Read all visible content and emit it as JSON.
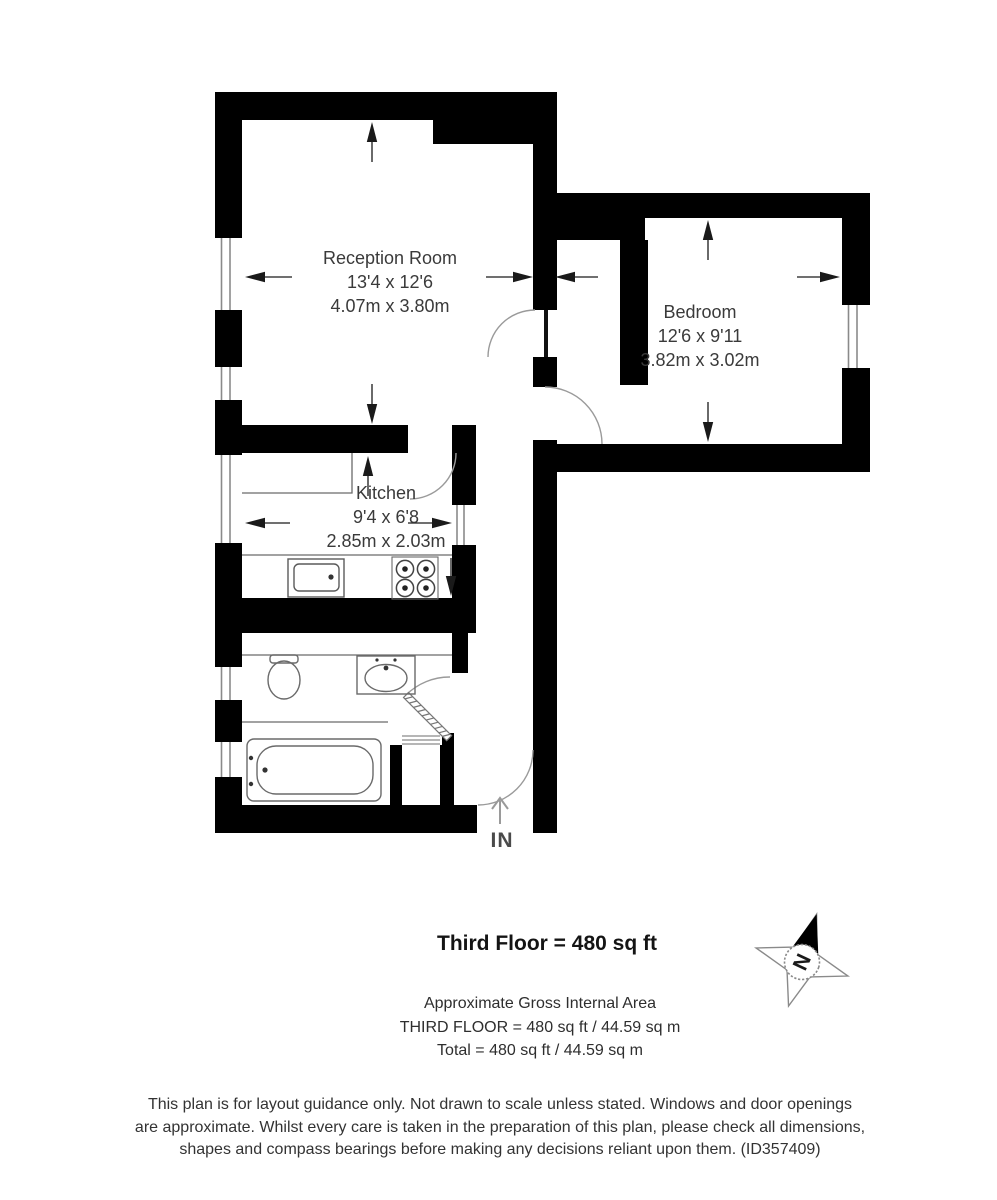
{
  "floor_plan": {
    "rooms": [
      {
        "name": "Reception Room",
        "imperial": "13'4 x 12'6",
        "metric": "4.07m x 3.80m"
      },
      {
        "name": "Bedroom",
        "imperial": "12'6 x 9'11",
        "metric": "3.82m x 3.02m"
      },
      {
        "name": "Kitchen",
        "imperial": "9'4 x 6'8",
        "metric": "2.85m x 2.03m"
      }
    ],
    "entrance_label": "IN",
    "compass_label": "N"
  },
  "summary": {
    "title": "Third Floor = 480 sq ft",
    "subtitle": "Approximate Gross Internal Area",
    "floor_line": "THIRD FLOOR = 480 sq ft / 44.59 sq m",
    "total_line": "Total = 480 sq ft / 44.59 sq m"
  },
  "disclaimer": {
    "line1": "This plan is for layout guidance only. Not drawn to scale unless stated. Windows and door openings",
    "line2": "are approximate. Whilst every care is taken in the preparation of this plan, please check all dimensions,",
    "line3": "shapes and compass bearings before making any decisions reliant upon them. (ID357409)"
  },
  "colors": {
    "wall": "#000000",
    "fixture_line": "#6a6a6a",
    "door_arc": "#9a9a9a",
    "text": "#3a3a3a"
  }
}
